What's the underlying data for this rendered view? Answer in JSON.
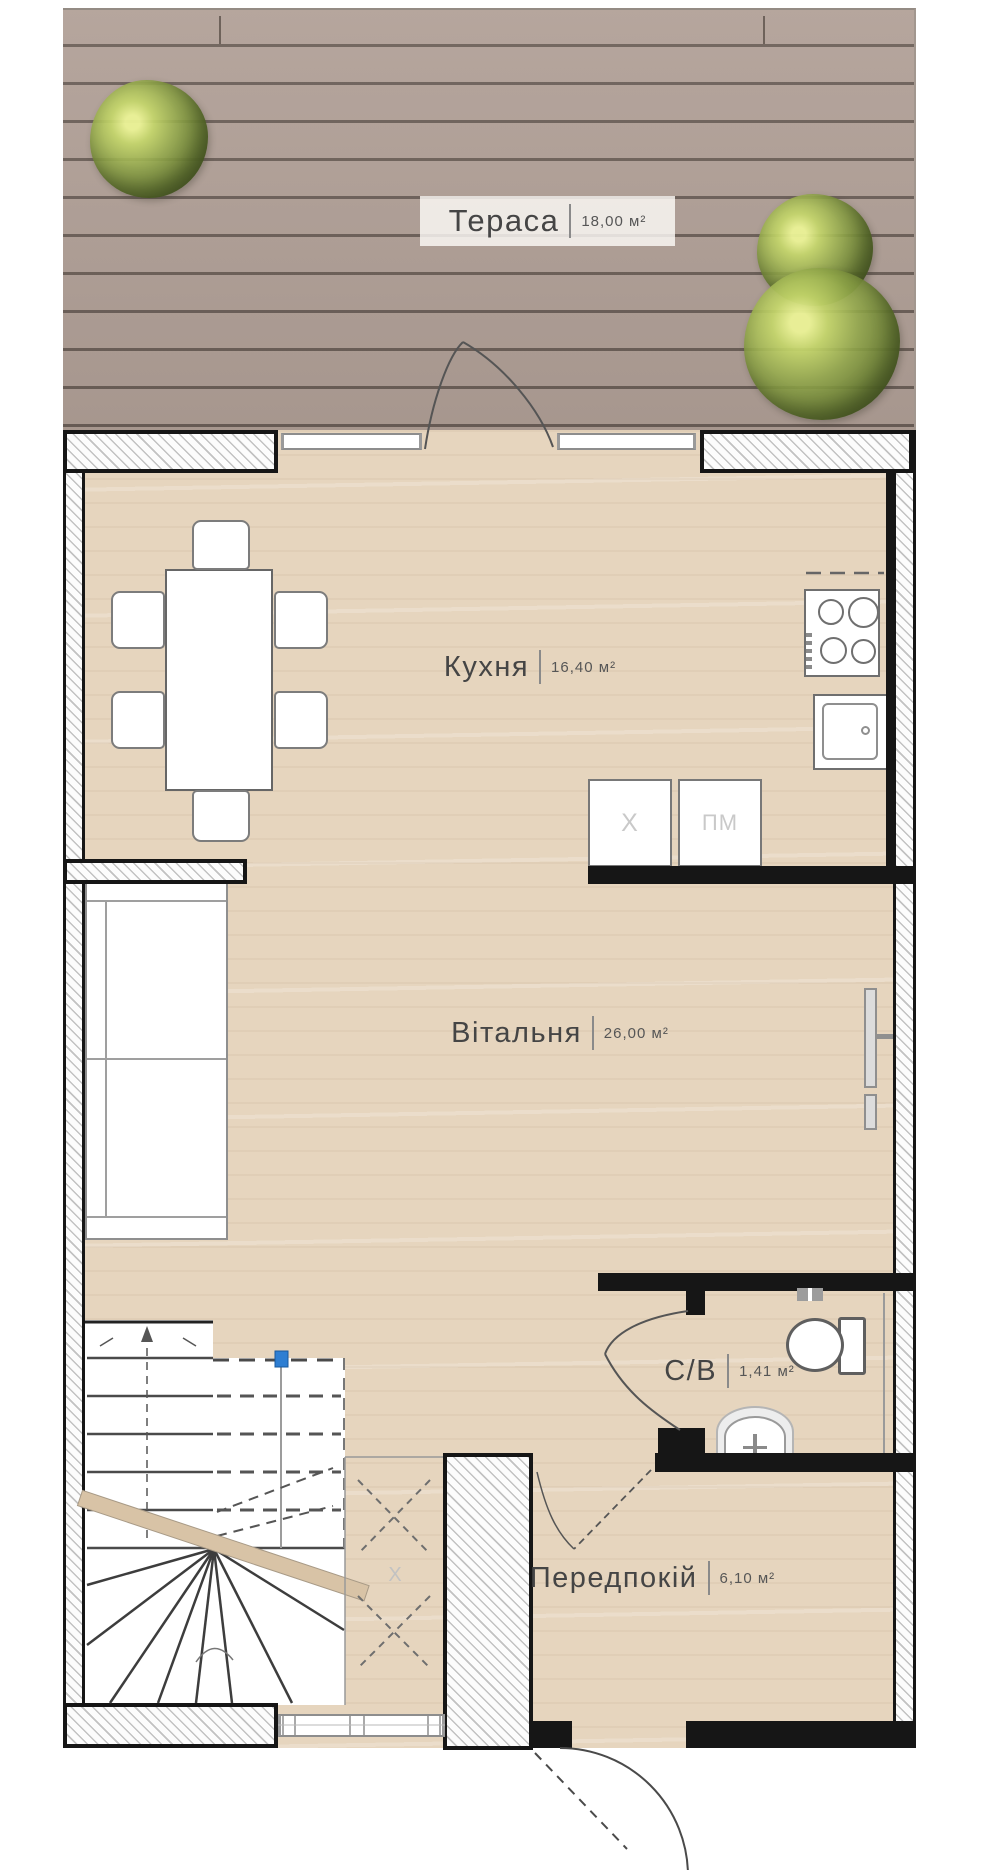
{
  "rooms": [
    {
      "name": "Тераса",
      "area": "18,00 м²"
    },
    {
      "name": "Кухня",
      "area": "16,40 м²"
    },
    {
      "name": "Вітальня",
      "area": "26,00 м²"
    },
    {
      "name": "С/В",
      "area": "1,41 м²"
    },
    {
      "name": "Передпокій",
      "area": "6,10 м²"
    }
  ],
  "labels": {
    "fridge": "Х",
    "dishwasher": "ПМ",
    "understairs": "Х"
  },
  "colors": {
    "wall": "#161616",
    "floor_wood": "#e6d5be",
    "deck": "#b1a097",
    "bush_green": "#7d9140",
    "stair_marker_blue": "#2e7ed2",
    "label_text": "#454545"
  }
}
